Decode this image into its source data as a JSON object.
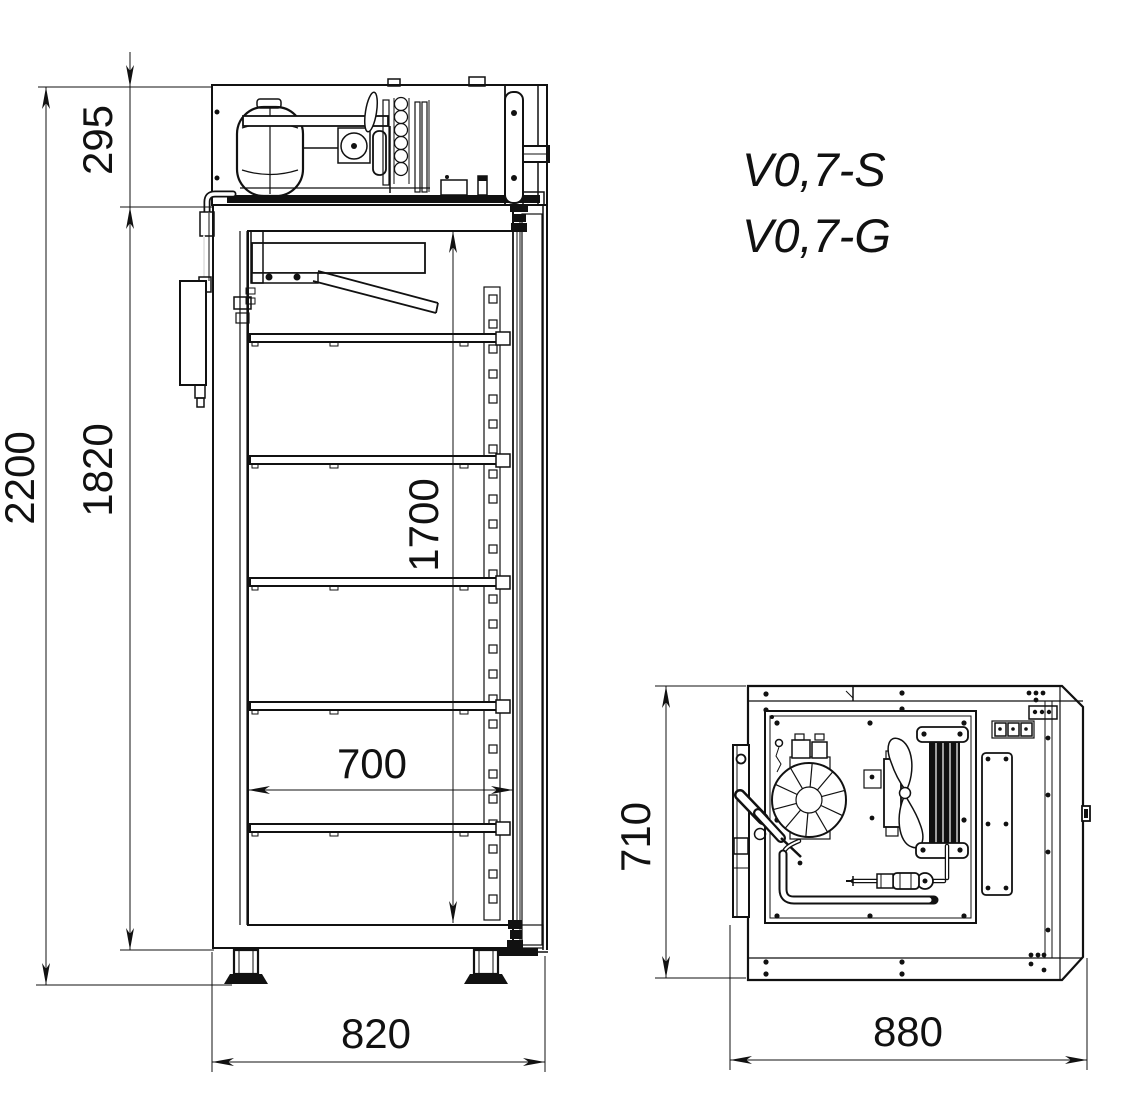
{
  "drawing_title": "Refrigerated cabinet dimensional drawing",
  "models": {
    "line1": "V0,7-S",
    "line2": "V0,7-G"
  },
  "side_view": {
    "name": "side cross-section view",
    "dims": {
      "overall_height": "2200",
      "body_height": "1820",
      "machine_compartment_height": "295",
      "interior_height": "1700",
      "interior_depth": "700",
      "overall_depth": "820"
    }
  },
  "top_view": {
    "name": "machine compartment top view",
    "dims": {
      "depth": "710",
      "width": "880"
    }
  },
  "colors": {
    "line": "#111111",
    "background": "#ffffff"
  }
}
